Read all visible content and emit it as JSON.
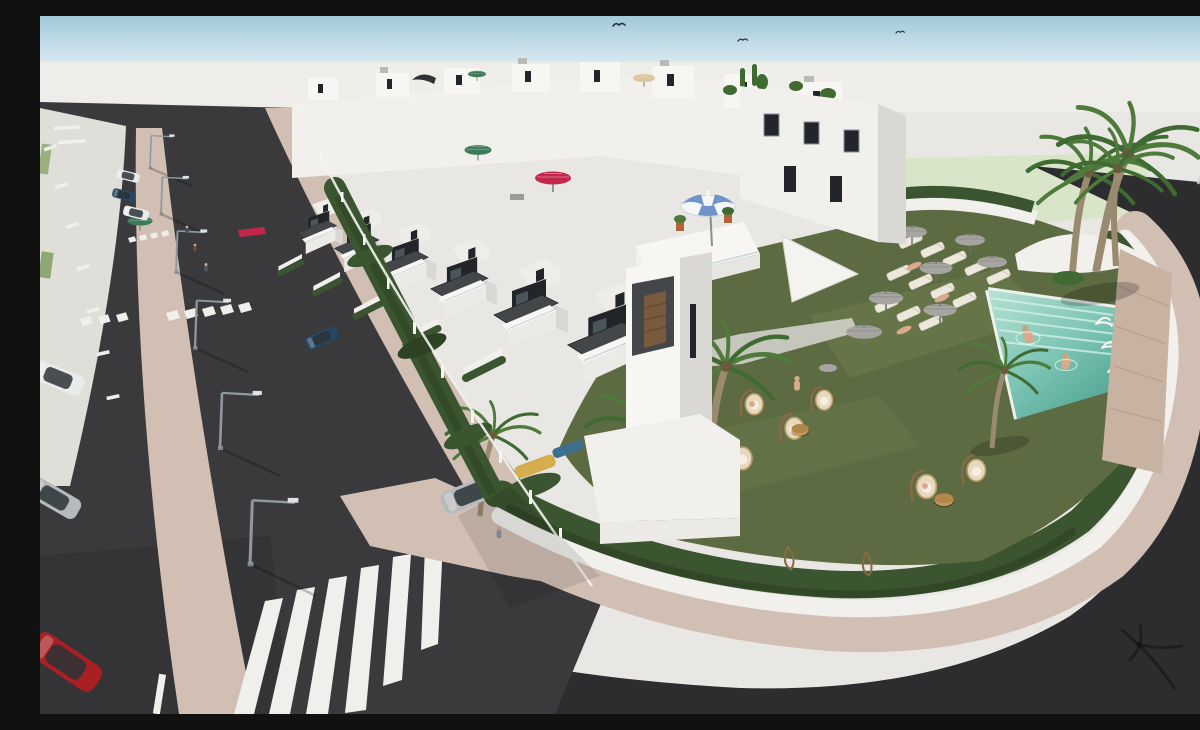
{
  "palette": {
    "sky_top": "#a2c9da",
    "sky_horizon": "#dcebf1",
    "ground": "#e9e7e3",
    "ground_light": "#efedea",
    "field": "#d8e5c8",
    "asphalt": "#2d2d2f",
    "asphalt_light": "#3a3a3d",
    "parking": "#e0ded9",
    "paver": "#d2bfb3",
    "white_wall": "#f1f0ec",
    "white_bright": "#f7f6f3",
    "white_shade": "#d9d8d4",
    "charcoal": "#43474a",
    "opening_dark": "#22262a",
    "glass": "#b7ccd2",
    "hedge": "#3c5531",
    "hedge_dark": "#2d4223",
    "lawn": "#5d6b42",
    "lawn_light": "#6e7d4e",
    "path_concrete": "#d8d7d1",
    "pool_light": "#a8dccd",
    "pool_deep": "#4fa493",
    "pool_stripe": "#d4f0e7",
    "stone_wall": "#c8b2a2",
    "umbrella_gray": "#a6a5a1",
    "umbrella_red": "#c2274b",
    "umbrella_green": "#3c7a58",
    "umbrella_tan": "#d9c79b",
    "parasol_blue": "#6f94c9",
    "parasol_white": "#f4f6f8",
    "wood_door": "#7a5a3d",
    "terracotta": "#b0633c",
    "wicker": "#e6d9bd",
    "wicker_dark": "#8a6a45",
    "car_red": "#a81f24",
    "car_white": "#e9eaea",
    "car_silver": "#b7babc",
    "car_blue": "#274864",
    "car_yellow": "#d5ad4e",
    "car_teal": "#3f6f8f",
    "lamp_metal": "#8f989e",
    "marking_white": "#efefec",
    "skin": "#d9a98c",
    "trunk": "#9a8a70",
    "frond": "#4e7a3c",
    "frond_dark": "#3f6b32",
    "bird": "#2c3437"
  },
  "scene": {
    "type": "architectural-3d-render",
    "description": "Aerial 3D rendering of a new-build development of white terraced townhouses with rooftop terraces, parasols and plants; front gardens with hedges and parked cars; a communal garden with lawn, sun loungers, gray umbrellas, hanging wicker chairs, palm trees and a turquoise swimming pool with two swimmers; bordered by dark asphalt streets with zebra crossings, beige paver sidewalks, street lamps and parked cars under a pale blue sky.",
    "inventory": {
      "birds": 3,
      "street_lamps": 6,
      "zebra_crossings": 3,
      "parking_stall_markings": true,
      "street_parked_cars": [
        "white sedan",
        "dark-blue sedan",
        "white sedan",
        "white hatchback",
        "silver car",
        "red hatchback"
      ],
      "driveway_cars": [
        "silver hatchback",
        "dark-grey car",
        "yellow car",
        "teal car"
      ],
      "rooftop_parasols": [
        "crimson",
        "green",
        "green",
        "tan",
        "blue-white striped",
        "dark awning"
      ],
      "shade_sails": 1,
      "sun_loungers": 12,
      "lounger_umbrellas": 7,
      "hanging_wicker_chairs": 7,
      "side_tables": 3,
      "palm_trees": 9,
      "pedestrians": 5,
      "pool": {
        "swimmers": 2,
        "color": "turquoise",
        "entry_steps": true
      }
    }
  }
}
